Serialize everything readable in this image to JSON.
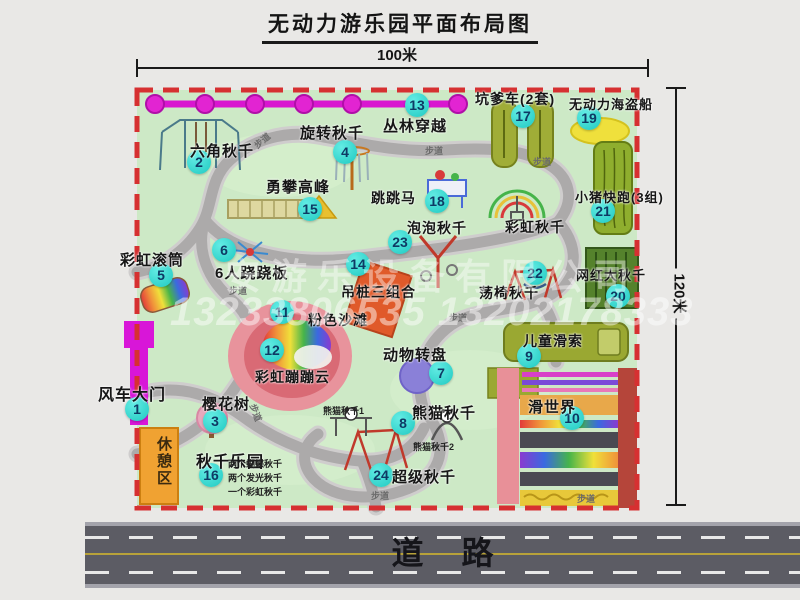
{
  "title": "无动力游乐园平面布局图",
  "dimensions": {
    "width_label": "100米",
    "height_label": "120米"
  },
  "road": {
    "label": "道路"
  },
  "watermark": {
    "company": "安游乐设备有限公司",
    "phone": "13233806535 13202178333"
  },
  "rest_area": {
    "label": "休憩区"
  },
  "walkway": {
    "label": "步道"
  },
  "colors": {
    "badge": "#2fd8ce",
    "park_fill": "#cde9c6",
    "border_red": "#d63031",
    "road": "#5c5c64",
    "zipline_magenta": "#d916d0",
    "gate_magenta": "#d816d8",
    "rest_area_orange": "#f0a232"
  },
  "map": {
    "attractions": [
      {
        "n": 1,
        "label": "风车大门",
        "lx": 98,
        "ly": 381,
        "bx": 137,
        "by": 409,
        "fs": 16
      },
      {
        "n": 2,
        "label": "六角秋千",
        "lx": 190,
        "ly": 140,
        "bx": 199,
        "by": 162,
        "fs": 15
      },
      {
        "n": 3,
        "label": "樱花树",
        "lx": 202,
        "ly": 393,
        "bx": 215,
        "by": 421,
        "fs": 15
      },
      {
        "n": 4,
        "label": "旋转秋千",
        "lx": 300,
        "ly": 122,
        "bx": 345,
        "by": 152,
        "fs": 15
      },
      {
        "n": 5,
        "label": "彩虹滚筒",
        "lx": 120,
        "ly": 249,
        "bx": 161,
        "by": 275,
        "fs": 15
      },
      {
        "n": 6,
        "label": "6人跷跷板",
        "lx": 215,
        "ly": 262,
        "bx": 224,
        "by": 250,
        "fs": 15
      },
      {
        "n": 7,
        "label": "动物转盘",
        "lx": 383,
        "ly": 344,
        "bx": 441,
        "by": 373,
        "fs": 15
      },
      {
        "n": 8,
        "label": "熊猫秋千",
        "lx": 412,
        "ly": 402,
        "bx": 403,
        "by": 423,
        "fs": 15
      },
      {
        "n": 9,
        "label": "儿童滑索",
        "lx": 523,
        "ly": 331,
        "bx": 529,
        "by": 356,
        "fs": 14
      },
      {
        "n": 10,
        "label": "滑世界",
        "lx": 528,
        "ly": 396,
        "bx": 572,
        "by": 418,
        "fs": 15
      },
      {
        "n": 11,
        "label": "粉色沙滩",
        "lx": 308,
        "ly": 310,
        "bx": 282,
        "by": 312,
        "fs": 14
      },
      {
        "n": 12,
        "label": "彩虹蹦蹦云",
        "lx": 255,
        "ly": 367,
        "bx": 272,
        "by": 350,
        "fs": 14
      },
      {
        "n": 13,
        "label": "丛林穿越",
        "lx": 383,
        "ly": 115,
        "bx": 417,
        "by": 105,
        "fs": 15
      },
      {
        "n": 14,
        "label": "吊桩三组合",
        "lx": 341,
        "ly": 282,
        "bx": 358,
        "by": 264,
        "fs": 14
      },
      {
        "n": 15,
        "label": "勇攀高峰",
        "lx": 266,
        "ly": 176,
        "bx": 310,
        "by": 209,
        "fs": 15
      },
      {
        "n": 16,
        "label": "秋千乐园",
        "lx": 196,
        "ly": 448,
        "bx": 211,
        "by": 475,
        "fs": 16
      },
      {
        "n": 17,
        "label": "坑爹车(2套)",
        "lx": 475,
        "ly": 89,
        "bx": 523,
        "by": 116,
        "fs": 14
      },
      {
        "n": 18,
        "label": "跳跳马",
        "lx": 371,
        "ly": 188,
        "bx": 437,
        "by": 201,
        "fs": 14
      },
      {
        "n": 19,
        "label": "无动力海盗船",
        "lx": 569,
        "ly": 94,
        "bx": 589,
        "by": 118,
        "fs": 13
      },
      {
        "n": 20,
        "label": "网红大秋千",
        "lx": 576,
        "ly": 265,
        "bx": 618,
        "by": 296,
        "fs": 13
      },
      {
        "n": 21,
        "label": "小猪快跑(3组)",
        "lx": 575,
        "ly": 187,
        "bx": 603,
        "by": 211,
        "fs": 13
      },
      {
        "n": 22,
        "label": "荡椅秋千",
        "lx": 479,
        "ly": 283,
        "bx": 535,
        "by": 273,
        "fs": 14
      },
      {
        "n": 23,
        "label": "泡泡秋千",
        "lx": 407,
        "ly": 218,
        "bx": 400,
        "by": 242,
        "fs": 14
      },
      {
        "n": 24,
        "label": "超级秋千",
        "lx": 392,
        "ly": 466,
        "bx": 381,
        "by": 475,
        "fs": 15
      }
    ],
    "extra_labels": [
      {
        "text": "彩虹秋千",
        "x": 505,
        "y": 217,
        "fs": 14
      }
    ],
    "notes": [
      {
        "text": "熊猫秋千1",
        "x": 323,
        "y": 404
      },
      {
        "text": "熊猫秋千2",
        "x": 413,
        "y": 440
      },
      {
        "text": "两个蝴蝶秋千",
        "x": 228,
        "y": 457
      },
      {
        "text": "两个发光秋千",
        "x": 228,
        "y": 471
      },
      {
        "text": "一个彩虹秋千",
        "x": 228,
        "y": 485
      }
    ],
    "walkway_spots": [
      {
        "x": 253,
        "y": 134,
        "rot": -40
      },
      {
        "x": 425,
        "y": 144,
        "rot": 0
      },
      {
        "x": 533,
        "y": 155,
        "rot": 0
      },
      {
        "x": 229,
        "y": 284,
        "rot": 0
      },
      {
        "x": 449,
        "y": 311,
        "rot": 0
      },
      {
        "x": 371,
        "y": 489,
        "rot": 0
      },
      {
        "x": 577,
        "y": 492,
        "rot": 0
      },
      {
        "x": 247,
        "y": 406,
        "rot": 70
      }
    ]
  }
}
